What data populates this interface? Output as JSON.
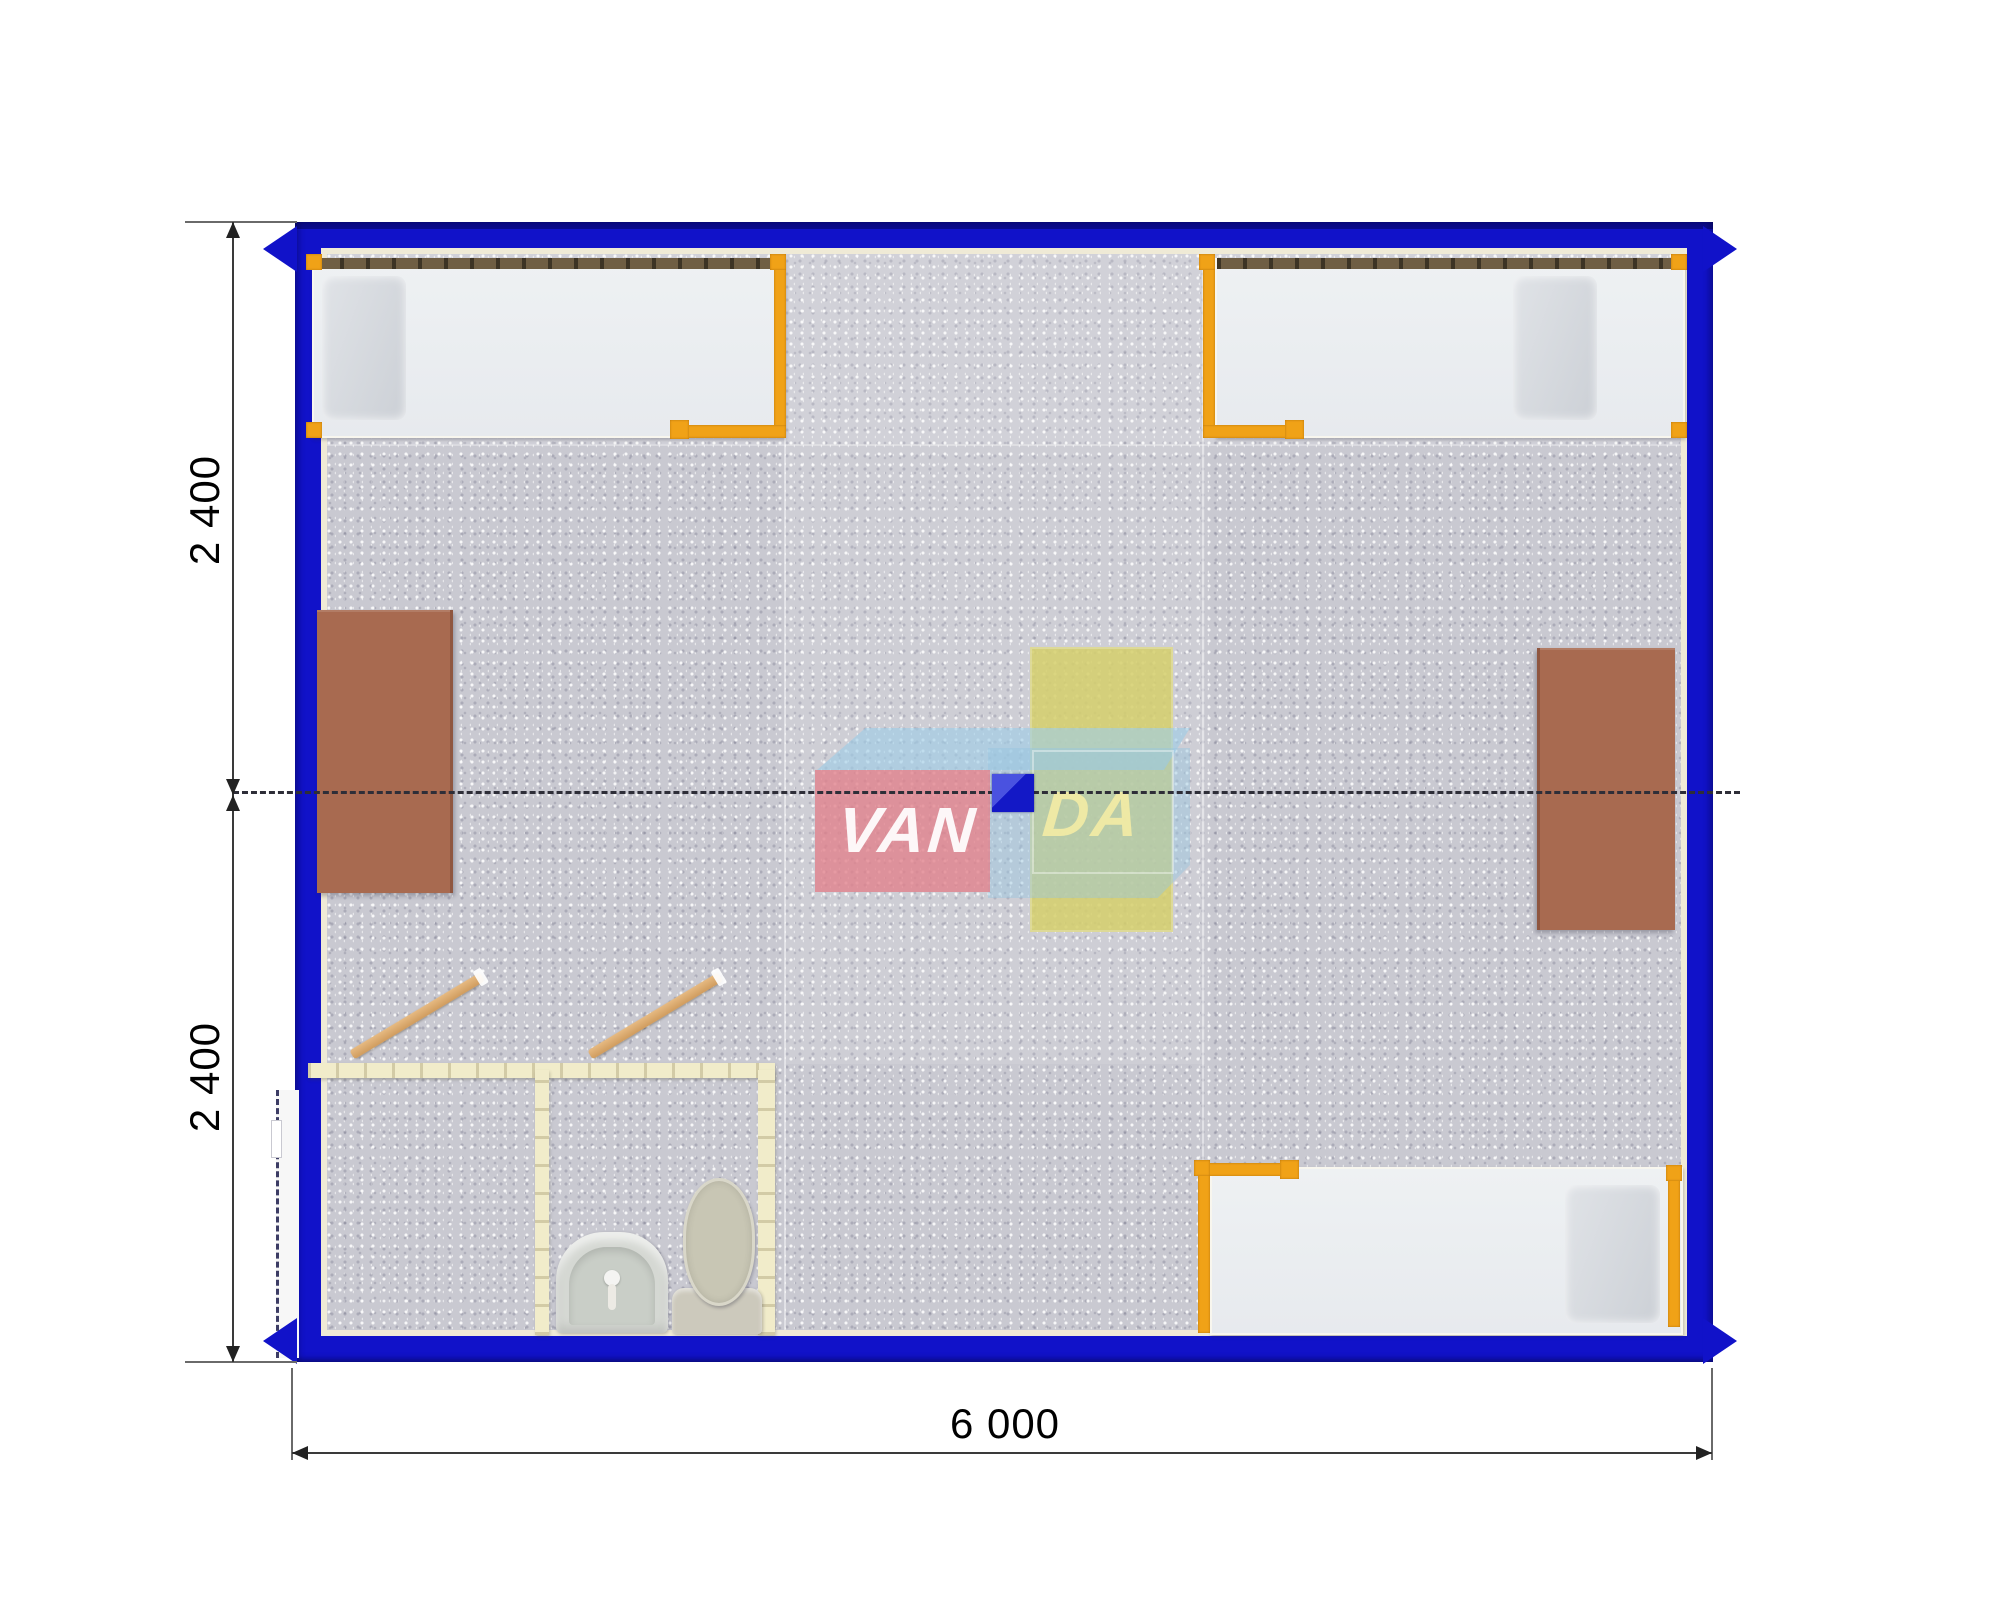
{
  "scene": {
    "description": "Top-down 3D floor plan render of a 6.0 x 2.4 m modular container cabin with three beds, two desks, a table and a bathroom block",
    "watermark": {
      "part1": "VAN",
      "part2": "DA"
    }
  },
  "dimensions": {
    "left_top": "2 400",
    "left_bottom": "2 400",
    "bottom": "6 000"
  },
  "colors": {
    "frame_blue": "#1112c9",
    "liner_cream": "#efead6",
    "floor_gray": "#c9c9d1",
    "bed_frame_orange": "#f0a217",
    "mattress_white": "#eef1f3",
    "pillow_gray": "#d9dce0",
    "headboard_brown": "#6f5e44",
    "desk_brown": "#a86a50",
    "table_yellow": "#d5cf6b",
    "bathroom_wall_cream": "#f1ecca",
    "fixture_gray": "#d5d8d3",
    "toilet_beige": "#c8c6b4",
    "door_wood_tan": "#dcab6f",
    "logo_red": "#e2808a",
    "logo_blue": "#94c6e2",
    "center_marker_blue": "#1318c6",
    "dimension_text": "#000000"
  }
}
